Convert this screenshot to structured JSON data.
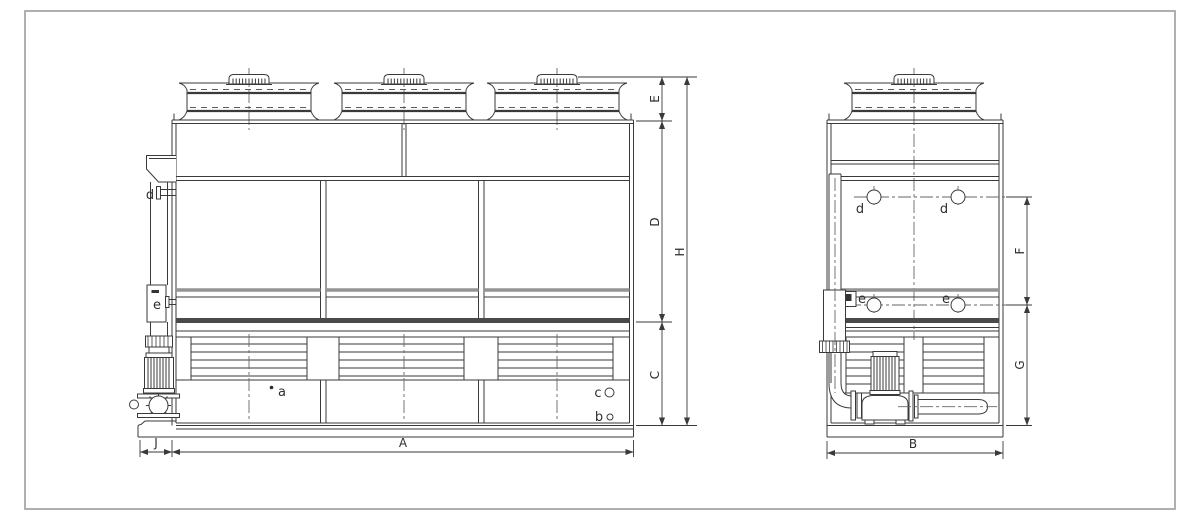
{
  "drawing": {
    "background": "#ffffff",
    "frame_color": "#9c9c9c",
    "line_color": "#3a3a3a",
    "centerline_color": "#666666",
    "band_gray": "#949494",
    "band_dark": "#4a4a4a"
  },
  "front_view": {
    "dim_labels": {
      "E": "E",
      "D": "D",
      "C": "C",
      "H": "H",
      "A": "A",
      "J": "J"
    },
    "port_labels": {
      "a": "a",
      "b": "b",
      "c": "c",
      "d": "d",
      "e": "e"
    }
  },
  "side_view": {
    "dim_labels": {
      "F": "F",
      "G": "G",
      "B": "B"
    },
    "port_labels": {
      "d_left": "d",
      "d_right": "d",
      "e_left": "e",
      "e_right": "e"
    }
  }
}
